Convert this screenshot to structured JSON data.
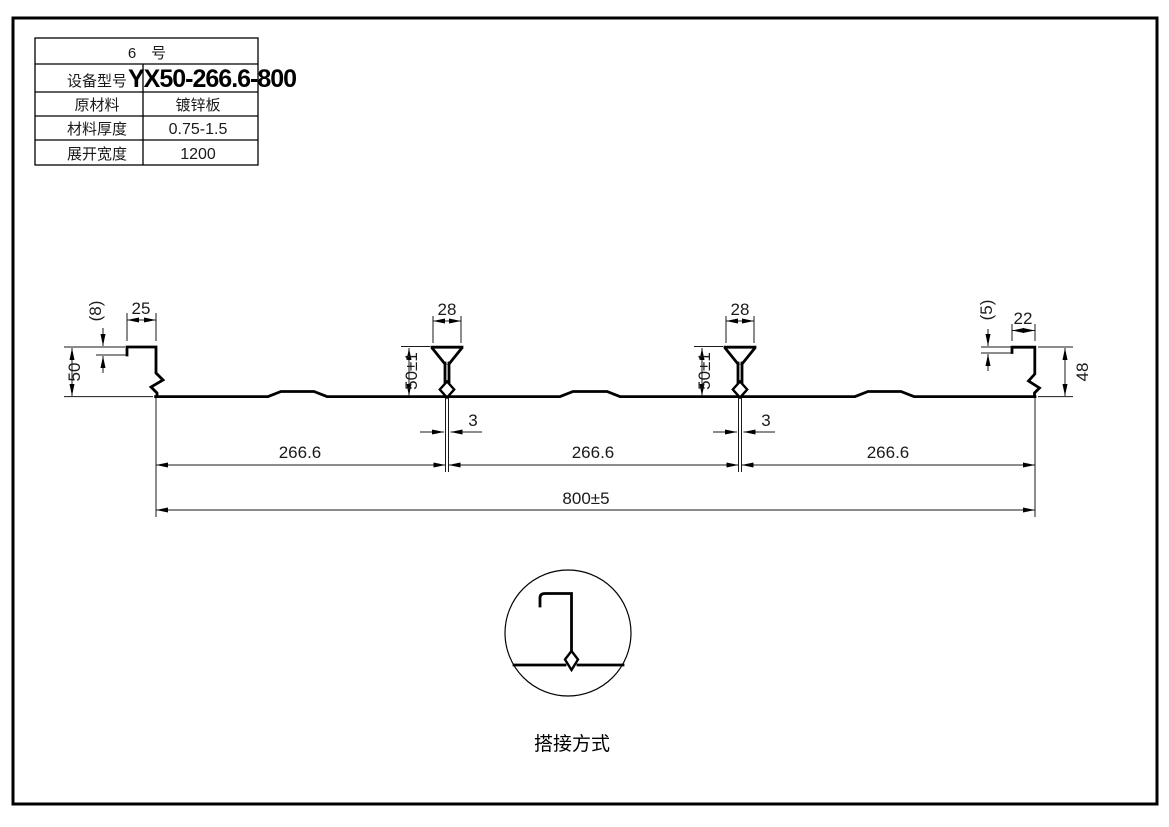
{
  "drawing": {
    "spec_table": {
      "title": "6　号",
      "rows": [
        {
          "label": "设备型号",
          "value": "YX50-266.6-800"
        },
        {
          "label": "原材料",
          "value": "镀锌板"
        },
        {
          "label": "材料厚度",
          "value": "0.75-1.5"
        },
        {
          "label": "展开宽度",
          "value": "1200"
        }
      ]
    },
    "dims": {
      "left_lip": "(8)",
      "left_flange": "25",
      "left_height": "50",
      "rib1_width": "28",
      "rib1_height": "50±1",
      "rib1_stem": "3",
      "rib2_width": "28",
      "rib2_height": "50±1",
      "rib2_stem": "3",
      "right_lip": "(5)",
      "right_flange": "22",
      "right_height": "48",
      "pitch_1": "266.6",
      "pitch_2": "266.6",
      "pitch_3": "266.6",
      "overall": "800±5"
    },
    "detail_label": "搭接方式",
    "line_color": "#000000",
    "bg_color": "#ffffff"
  }
}
